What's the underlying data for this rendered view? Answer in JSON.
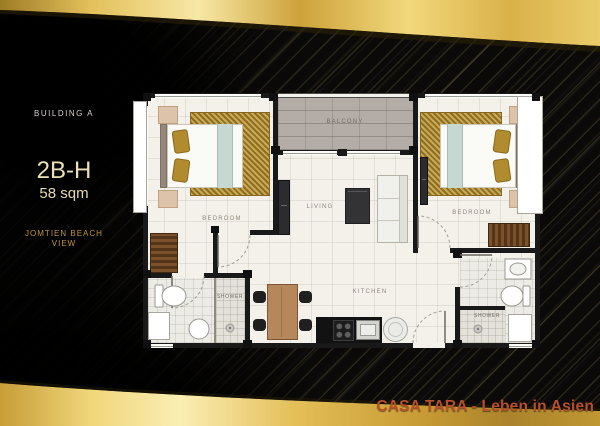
{
  "panel": {
    "building_label": "BUILDING A",
    "unit_code": "2B-H",
    "unit_area": "58 sqm",
    "view_line1": "JOMTIEN BEACH",
    "view_line2": "VIEW"
  },
  "footer": {
    "brand_text": "CASA TARA - Leben in Asien"
  },
  "floorplan": {
    "rooms": {
      "bedroom_left": "BEDROOM",
      "bedroom_right": "BEDROOM",
      "balcony": "BALCONY",
      "living": "LIVING",
      "kitchen": "KITCHEN",
      "shower_left": "SHOWER",
      "shower_right": "SHOWER"
    }
  },
  "colors": {
    "ribbon_gold": "#e3c05a",
    "panel_unit_text": "#ece1b6",
    "panel_view_text": "#c2943e",
    "footer_text": "#b5502b",
    "wall": "#191919",
    "floor": "#f3f1ea",
    "balcony_floor": "#b4ada7",
    "rug_gold": "#a3802c"
  }
}
